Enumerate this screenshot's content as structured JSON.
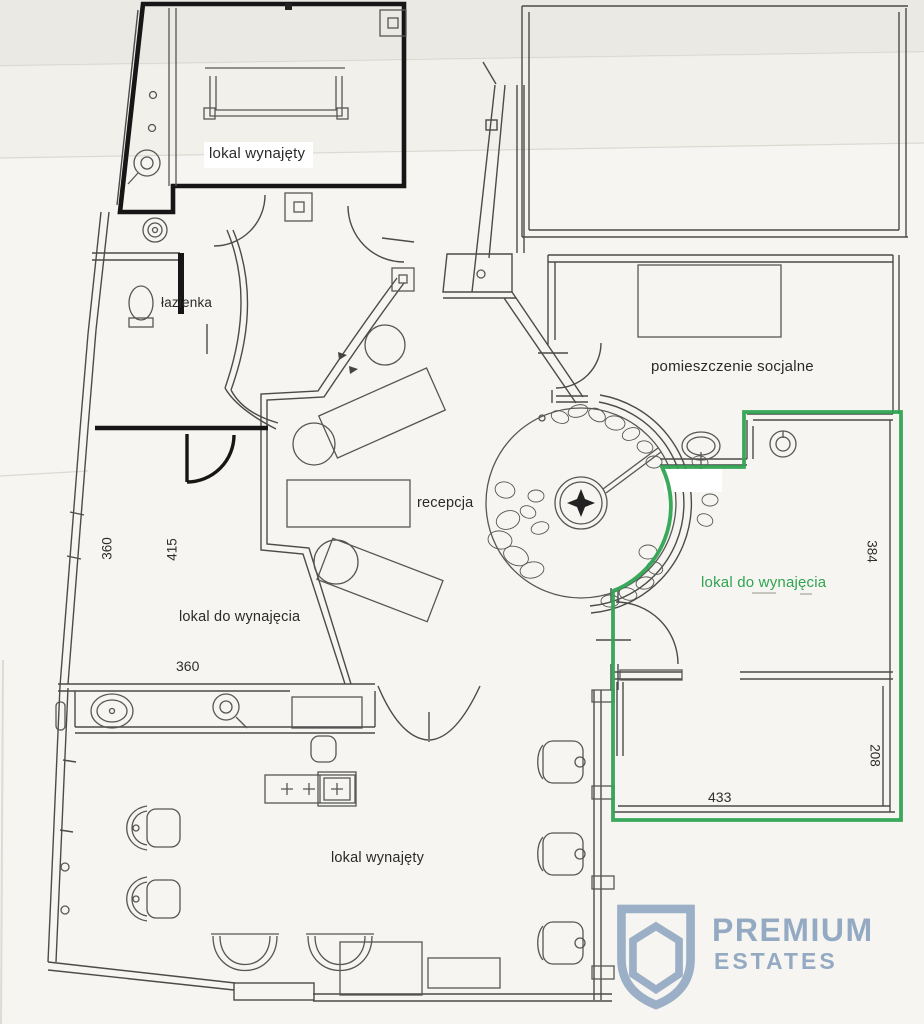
{
  "plan": {
    "labels": {
      "unit_rented_top": "lokal wynajęty",
      "bathroom": "łazienka",
      "social_room": "pomieszczenie socjalne",
      "reception": "recepcja",
      "unit_for_rent_left": "lokal do wynajęcia",
      "unit_for_rent_right": "lokal do wynajęcia",
      "unit_rented_bottom": "lokal wynajęty"
    },
    "dimensions_cm": {
      "left_wall": "360",
      "left_depth": "415",
      "left_width": "360",
      "right_depth_upper": "384",
      "right_depth_lower": "208",
      "right_width": "433"
    }
  },
  "colors": {
    "highlight_green": "#2fa452",
    "ink": "#4b4b4b",
    "ink_bold": "#161616",
    "paper": "#f6f5f1",
    "logo_blue": "#94aac3"
  },
  "watermark": {
    "line1": "PREMIUM",
    "line2": "ESTATES"
  }
}
